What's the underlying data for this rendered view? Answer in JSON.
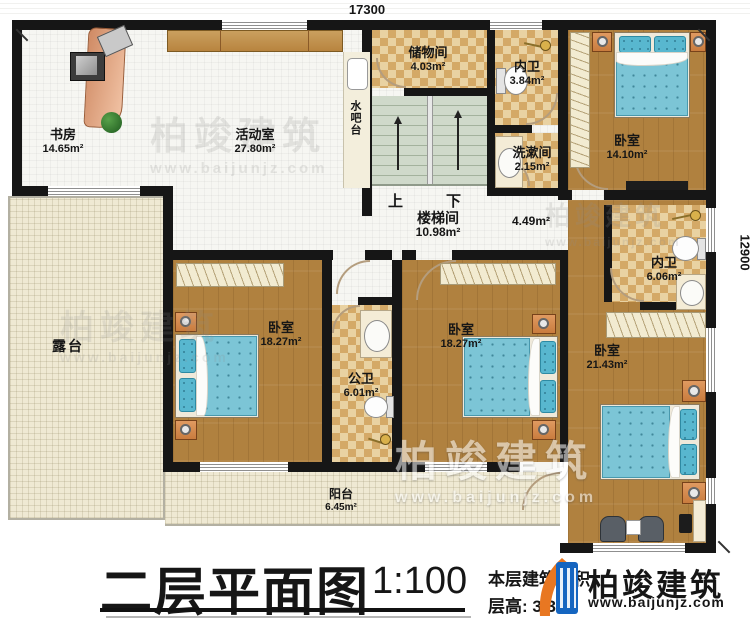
{
  "dims": {
    "top": "17300",
    "right": "12900"
  },
  "rooms": {
    "study": {
      "name": "书房",
      "area": "14.65m²"
    },
    "activity": {
      "name": "活动室",
      "area": "27.80m²"
    },
    "waterbar": {
      "name": "水吧台"
    },
    "storage": {
      "name": "储物间",
      "area": "4.03m²"
    },
    "bath_top": {
      "name": "内卫",
      "area": "3.84m²"
    },
    "washroom": {
      "name": "洗漱间",
      "area": "2.15m²"
    },
    "bedroom_tr": {
      "name": "卧室",
      "area": "14.10m²"
    },
    "stairwell": {
      "name": "楼梯间",
      "area": "10.98m²",
      "up": "上",
      "down": "下"
    },
    "corridor": {
      "area": "4.49m²"
    },
    "bath_right": {
      "name": "内卫",
      "area": "6.06m²"
    },
    "bedroom_left": {
      "name": "卧室",
      "area": "18.27m²"
    },
    "bath_public": {
      "name": "公卫",
      "area": "6.01m²"
    },
    "bedroom_mid": {
      "name": "卧室",
      "area": "18.27m²"
    },
    "bedroom_br": {
      "name": "卧室",
      "area": "21.43m²"
    },
    "terrace": {
      "name": "露台"
    },
    "balcony": {
      "name": "阳台",
      "area": "6.45m²"
    }
  },
  "title": {
    "text": "二层平面图",
    "scale": "1:100"
  },
  "info": {
    "area_line": "本层建筑面积",
    "height_line": "层高: 3.3m"
  },
  "brand": {
    "name": "柏竣建筑",
    "url": "www.baijunjz.com"
  },
  "watermark": {
    "text": "柏竣建筑",
    "url": "www.baijunjz.com"
  },
  "colors": {
    "wall": "#161616",
    "wood": "#b0813f",
    "checker": "#d4a967",
    "bed": "#7cc5d6",
    "stair": "#cfd9ca",
    "logo_blue": "#1565c0",
    "logo_orange": "#e87722"
  }
}
